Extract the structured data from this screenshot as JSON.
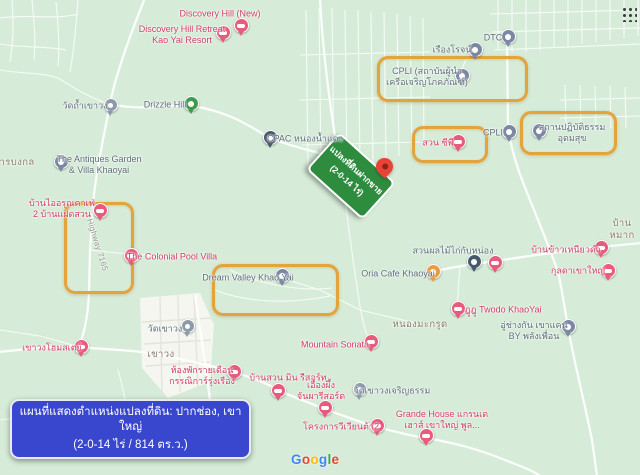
{
  "theme": {
    "map-bg": "#d6ecd8",
    "built-up": "#f4f6ef",
    "street": "#e3e5dc",
    "road": "#ffffff",
    "highlight": "#e5a33c",
    "caption-bg": "#3847cd",
    "caption-text": "#ffffff",
    "sign-bg": "#2e8c3e",
    "sign-text": "#ffffff",
    "dest-pin": "#e94335",
    "pin-lodging": "#e85b7d",
    "pin-poi": "#7b88a3",
    "pin-temple": "#8e99a9",
    "pin-nature": "#3f9b4a",
    "pin-cafe": "#f0993c",
    "pin-industrial": "#47586c",
    "pin-building": "#7b88a3",
    "label-lodging": "#cf3a64",
    "label-poi": "#5d6b78",
    "label-area": "#8a7a68",
    "label-road": "#8f9388"
  },
  "caption": {
    "line1": "แผนที่แสดงตำแหน่งแปลงที่ดิน: ปากช่อง, เขาใหญ่",
    "line2": "(2-0-14 ไร่ / 814 ตร.ว.)"
  },
  "land_sign": {
    "line1": "แปลงที่ดินฝากขาย",
    "line2": "(2-0-14 ไร่)"
  },
  "google_logo": {
    "text": "Google",
    "letter_colors": [
      "#4285F4",
      "#EA4335",
      "#FBBC05",
      "#4285F4",
      "#34A853",
      "#EA4335"
    ]
  },
  "destination_pin": {
    "x": 376,
    "y": 158
  },
  "highlights": [
    {
      "name": "highlight-cpli-institute",
      "x": 377,
      "y": 56,
      "w": 145,
      "h": 40
    },
    {
      "name": "highlight-meditation",
      "x": 520,
      "y": 111,
      "w": 91,
      "h": 38
    },
    {
      "name": "highlight-suan-cp",
      "x": 412,
      "y": 126,
      "w": 70,
      "h": 31
    },
    {
      "name": "highlight-highway-area",
      "x": 64,
      "y": 202,
      "w": 64,
      "h": 86
    },
    {
      "name": "highlight-dream-valley",
      "x": 212,
      "y": 264,
      "w": 121,
      "h": 46
    }
  ],
  "markers": [
    {
      "name": "discovery-hill-new-pin",
      "type": "lodging",
      "x": 240,
      "y": 25
    },
    {
      "name": "discovery-hill-retreat-pin",
      "type": "lodging",
      "x": 222,
      "y": 32
    },
    {
      "name": "wat-tham-khaowong-pin",
      "type": "temple",
      "x": 110,
      "y": 105
    },
    {
      "name": "drizzle-hill-pin",
      "type": "nature",
      "x": 190,
      "y": 103
    },
    {
      "name": "cpac-nongnamdaeng-pin",
      "type": "industrial",
      "x": 269,
      "y": 137
    },
    {
      "name": "antiques-garden-pin",
      "type": "poi",
      "x": 60,
      "y": 161
    },
    {
      "name": "baan-i-arun-cafe-pin",
      "type": "lodging",
      "x": 99,
      "y": 210
    },
    {
      "name": "colonial-pool-villa-pin",
      "type": "lodging",
      "x": 130,
      "y": 255
    },
    {
      "name": "dream-valley-pin",
      "type": "poi",
      "x": 281,
      "y": 275
    },
    {
      "name": "dtc-pin",
      "type": "poi",
      "x": 507,
      "y": 36
    },
    {
      "name": "rueangrot-pin",
      "type": "poi",
      "x": 474,
      "y": 49
    },
    {
      "name": "cpli-institute-pin",
      "type": "poi",
      "x": 461,
      "y": 75
    },
    {
      "name": "suan-cp-pin",
      "type": "lodging",
      "x": 457,
      "y": 141
    },
    {
      "name": "cpli-pin",
      "type": "poi",
      "x": 508,
      "y": 131
    },
    {
      "name": "meditation-center-pin",
      "type": "building",
      "x": 538,
      "y": 130
    },
    {
      "name": "oria-cafe-pin",
      "type": "cafe",
      "x": 432,
      "y": 271
    },
    {
      "name": "fruit-garden-pin",
      "type": "industrial",
      "x": 473,
      "y": 261
    },
    {
      "name": "lodging-pin-unlabeled",
      "type": "lodging",
      "x": 494,
      "y": 262
    },
    {
      "name": "khao-niao-dam-pin",
      "type": "lodging",
      "x": 600,
      "y": 247
    },
    {
      "name": "kulada-khaoyai-pin",
      "type": "lodging",
      "x": 607,
      "y": 270
    },
    {
      "name": "twodo-khaoyai-pin",
      "type": "lodging",
      "x": 457,
      "y": 308
    },
    {
      "name": "garage-pin",
      "type": "poi",
      "x": 567,
      "y": 326
    },
    {
      "name": "mountain-sonata-pin",
      "type": "lodging",
      "x": 370,
      "y": 341
    },
    {
      "name": "khaowong-homestay-pin",
      "type": "lodging",
      "x": 80,
      "y": 346
    },
    {
      "name": "wat-khaowong-pin",
      "type": "temple",
      "x": 187,
      "y": 326
    },
    {
      "name": "monthly-room-pin",
      "type": "lodging",
      "x": 233,
      "y": 371
    },
    {
      "name": "baan-suan-min-pin",
      "type": "lodging",
      "x": 277,
      "y": 390
    },
    {
      "name": "ueang-phueng-pin",
      "type": "lodging",
      "x": 324,
      "y": 407
    },
    {
      "name": "wat-khaowong-charoen-pin",
      "type": "temple",
      "x": 359,
      "y": 389
    },
    {
      "name": "vivienta2-pin",
      "type": "lodging",
      "x": 376,
      "y": 425
    },
    {
      "name": "grande-house-pin",
      "type": "lodging",
      "x": 425,
      "y": 435
    }
  ],
  "labels": [
    {
      "name": "discovery-hill-new-label",
      "type": "lodging",
      "x": 220,
      "y": 14,
      "text": "Discovery Hill (New)"
    },
    {
      "name": "discovery-hill-retreat-label",
      "type": "lodging",
      "x": 182,
      "y": 35,
      "text": "Discovery Hill Retreat\nKao Yai Resort"
    },
    {
      "name": "wat-tham-khaowong-label",
      "type": "poi",
      "x": 85,
      "y": 106,
      "text": "วัดถ้ำเขาวง"
    },
    {
      "name": "drizzle-hill-label",
      "type": "poi",
      "x": 165,
      "y": 105,
      "text": "Drizzle Hill"
    },
    {
      "name": "cpac-label",
      "type": "poi",
      "x": 305,
      "y": 139,
      "text": "CPAC หนองน้ำแดง"
    },
    {
      "name": "antiques-garden-label",
      "type": "poi",
      "x": 99,
      "y": 165,
      "text": "The Antiques Garden\n& Villa Khaoyai"
    },
    {
      "name": "than-bongkol-label",
      "type": "area",
      "x": 14,
      "y": 163,
      "text": "ธารบงกล"
    },
    {
      "name": "baan-i-arun-label",
      "type": "lodging",
      "x": 62,
      "y": 209,
      "text": "บ้านไออรุณคาเฟ่\n2 บ้านแฝดสวน"
    },
    {
      "name": "highway-7165-label",
      "type": "road",
      "x": 97,
      "y": 245,
      "rot": 73,
      "text": "Highway 7165"
    },
    {
      "name": "colonial-pool-villa-label",
      "type": "lodging",
      "x": 172,
      "y": 257,
      "text": "The Colonial Pool Villa"
    },
    {
      "name": "dream-valley-label",
      "type": "poi",
      "x": 248,
      "y": 278,
      "text": "Dream Valley Khao Yai"
    },
    {
      "name": "dtc-label",
      "type": "poi",
      "x": 493,
      "y": 38,
      "text": "DTC"
    },
    {
      "name": "rueangrot-label",
      "type": "poi",
      "x": 452,
      "y": 50,
      "text": "เรืองโรจน์"
    },
    {
      "name": "cpli-institute-label",
      "type": "poi",
      "x": 427,
      "y": 77,
      "text": "CPLI (สถาบันผู้นำ\nเครือเจริญโภคภัณฑ์)"
    },
    {
      "name": "suan-cp-label",
      "type": "lodging",
      "x": 438,
      "y": 143,
      "text": "สวน ซีพี"
    },
    {
      "name": "cpli-label",
      "type": "poi",
      "x": 493,
      "y": 133,
      "text": "CPLI"
    },
    {
      "name": "meditation-center-label",
      "type": "poi",
      "x": 572,
      "y": 133,
      "text": "สถานปฏิบัติธรรม\nอุดมสุข"
    },
    {
      "name": "oria-cafe-label",
      "type": "poi",
      "x": 398,
      "y": 274,
      "text": "Oria Cafe Khaoyai"
    },
    {
      "name": "fruit-garden-label",
      "type": "poi",
      "x": 453,
      "y": 251,
      "text": "สวนผลไม้ไก่กับหน่อง"
    },
    {
      "name": "khao-niao-dam-label",
      "type": "lodging",
      "x": 566,
      "y": 250,
      "text": "บ้านข้าวเหนียวดำ"
    },
    {
      "name": "kulada-khaoyai-label",
      "type": "lodging",
      "x": 578,
      "y": 271,
      "text": "กุลดาเขาใหญ่"
    },
    {
      "name": "twodo-khaoyai-label",
      "type": "lodging",
      "x": 503,
      "y": 310,
      "text": "ฎูฎู Twodo KhaoYai"
    },
    {
      "name": "garage-label",
      "type": "poi",
      "x": 534,
      "y": 331,
      "text": "อู่ช่างกัน เขาแคน\nBY พลังเพื่อน"
    },
    {
      "name": "baan-mak-label",
      "type": "area",
      "x": 622,
      "y": 230,
      "text": "บ้านหมาก"
    },
    {
      "name": "nong-makrut-label",
      "type": "area",
      "x": 420,
      "y": 325,
      "text": "หนองมะกรูด"
    },
    {
      "name": "mountain-sonata-label",
      "type": "lodging",
      "x": 335,
      "y": 345,
      "text": "Mountain Sonata"
    },
    {
      "name": "khaowong-homestay-label",
      "type": "lodging",
      "x": 52,
      "y": 348,
      "text": "เขาวงโฮมสเตย์"
    },
    {
      "name": "wat-khaowong-label",
      "type": "poi",
      "x": 165,
      "y": 329,
      "text": "วัดเขาวง"
    },
    {
      "name": "khaowong-area-label",
      "type": "area",
      "x": 161,
      "y": 355,
      "text": "เขาวง"
    },
    {
      "name": "monthly-room-label",
      "type": "lodging",
      "x": 202,
      "y": 376,
      "text": "ห้องพักรายเดือน\nกรรณิการ์รุ่งเรือง"
    },
    {
      "name": "baan-suan-min-label",
      "type": "lodging",
      "x": 288,
      "y": 378,
      "text": "บ้านสวน มิน รีสอร์ท"
    },
    {
      "name": "ueang-phueng-label",
      "type": "lodging",
      "x": 321,
      "y": 391,
      "text": "เอื้องผึ้ง\nจันผารีสอร์ต"
    },
    {
      "name": "wat-charoen-label",
      "type": "poi",
      "x": 392,
      "y": 391,
      "text": "วัดเขาวงเจริญธรรม"
    },
    {
      "name": "vivienta2-label",
      "type": "lodging",
      "x": 341,
      "y": 427,
      "text": "โครงการวีเวียนต้า2"
    },
    {
      "name": "grande-house-label",
      "type": "lodging",
      "x": 442,
      "y": 420,
      "text": "Grande House แกรนเด\nเฮาส์ เขาใหญ่ พูล..."
    }
  ]
}
